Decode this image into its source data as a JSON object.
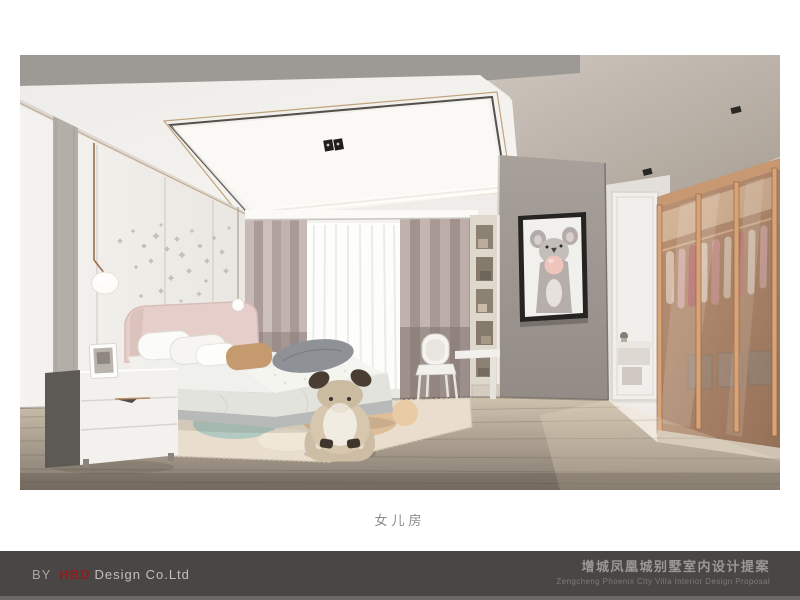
{
  "caption": {
    "text": "女儿房"
  },
  "footer": {
    "by_label": "BY",
    "brand": "HBD",
    "company": "Design Co.Ltd",
    "title_zh": "增城凤凰城别墅室内设计提案",
    "title_en": "Zengcheng Phoenix City Villa Interior Design Proposal",
    "bar_color": "#4a4645",
    "brand_color": "#8e1d1f",
    "text_color": "#b5b2af"
  },
  "rendering": {
    "subject": "girls-bedroom-interior-rendering",
    "artwork": "koala-blowing-pink-bubble",
    "palette": {
      "ceiling_white": "#f5f3f0",
      "ceiling_right_gray": "#bdb4aa",
      "wall_panel": "#f0eeea",
      "curtain_mauve_top": "#c3b4b0",
      "curtain_mauve_bottom": "#8e807c",
      "bed_headboard_pink": "#e6cfcb",
      "accent_pillow_tan": "#c49a6e",
      "blanket_gray": "#8e9196",
      "column_gray": "#9b948e",
      "wardrobe_copper": "#c89873",
      "rug_cream": "#e9decd",
      "rug_teal": "#a9c7c1",
      "rug_tan": "#dcb98f",
      "floor_wood": "#a3988c"
    }
  }
}
